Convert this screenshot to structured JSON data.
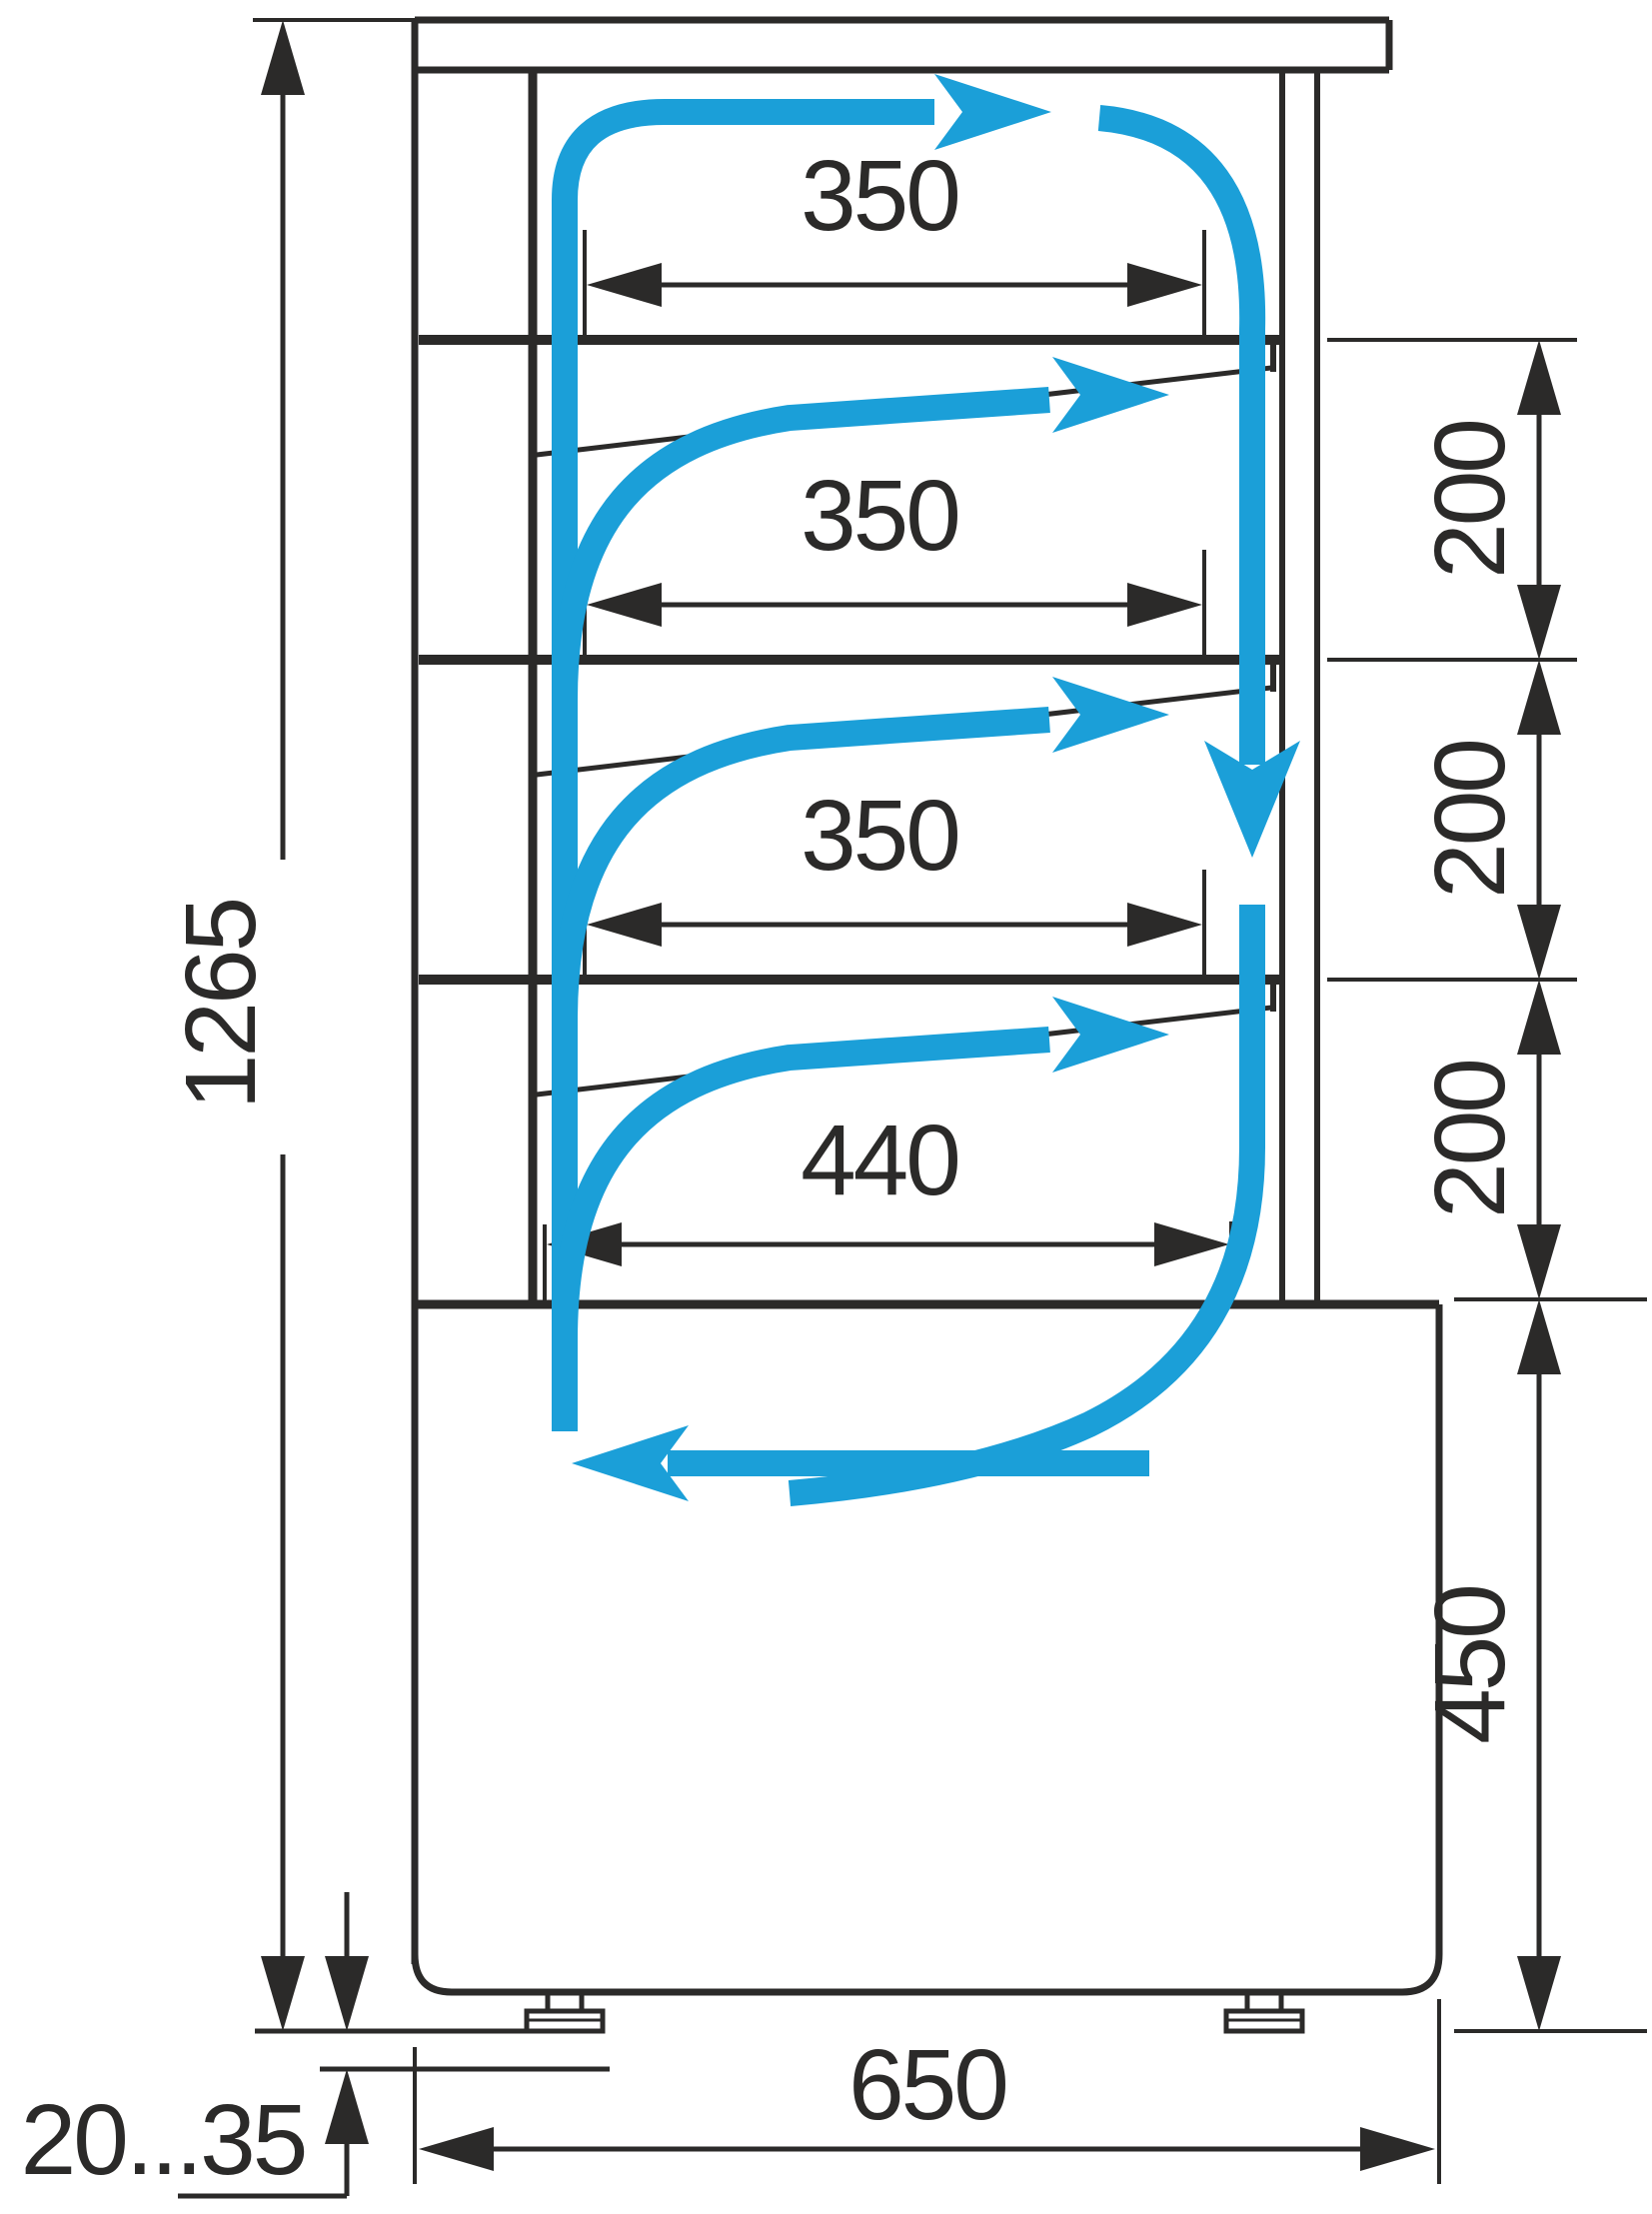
{
  "diagram": {
    "title": "refrigerated-display-case-side-section",
    "colors": {
      "line": "#2b2a29",
      "airflow": "#1b9fd8",
      "background": "#ffffff"
    },
    "dims": {
      "total_height": "1265",
      "shelf_width_1": "350",
      "shelf_width_2": "350",
      "shelf_width_3": "350",
      "bottom_shelf_width": "440",
      "shelf_gap_1": "200",
      "shelf_gap_2": "200",
      "shelf_gap_3": "200",
      "base_height": "450",
      "base_width": "650",
      "foot_adjust_range": "20...35"
    }
  }
}
